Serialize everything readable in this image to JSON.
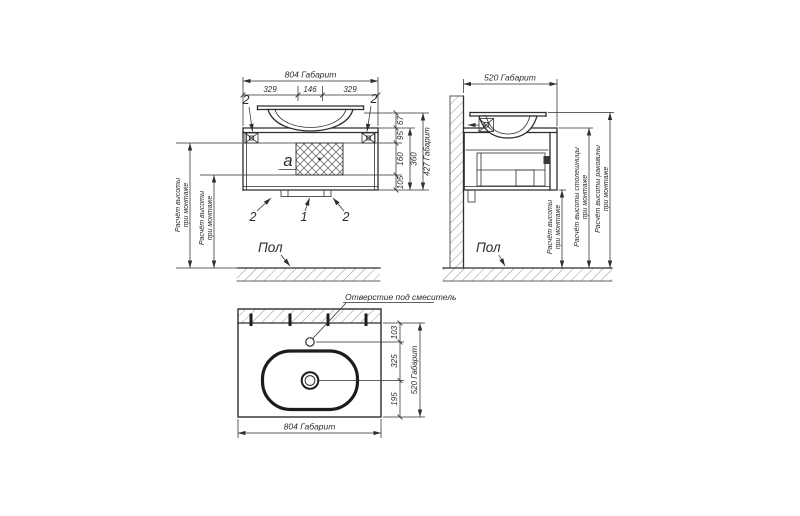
{
  "colors": {
    "line": "#2e2e2e",
    "text": "#2b2b2b",
    "background": "#ffffff"
  },
  "front": {
    "dim_width_total": "804 Габарит",
    "dim_width_left": "329",
    "dim_width_center": "146",
    "dim_width_right": "329",
    "callout_bracket_left": "2",
    "callout_bracket_right": "2",
    "callout_foot_left": "2",
    "callout_trap": "1",
    "callout_foot_right": "2",
    "detail_label": "а",
    "dim_h_sink": "67",
    "dim_h_top": "95",
    "dim_h_mid": "160",
    "dim_h_bottom": "105",
    "dim_h_cabinet": "360",
    "dim_height_total": "427 Габарит",
    "floor_label": "Пол",
    "mount_outer_line1": "Расчёт высоты",
    "mount_outer_line2": "при монтаже",
    "mount_inner_line1": "Расчёт высоты",
    "mount_inner_line2": "при монтаже"
  },
  "side": {
    "dim_depth_total": "520 Габарит",
    "floor_label": "Пол",
    "mount_cabinet_line1": "Расчёт высоты",
    "mount_cabinet_line2": "при монтаже",
    "mount_counter_line1": "Расчёт высоты столешницы",
    "mount_counter_line2": "при монтаже",
    "mount_sink_line1": "Расчёт высоты раковины",
    "mount_sink_line2": "при монтаже"
  },
  "top": {
    "faucet_hole_label": "Отверстие под смеситель",
    "dim_to_faucet": "103",
    "dim_faucet_to_drain": "325",
    "dim_drain_to_front": "195",
    "dim_depth_total": "520 Габарит",
    "dim_width_total": "804 Габарит"
  }
}
